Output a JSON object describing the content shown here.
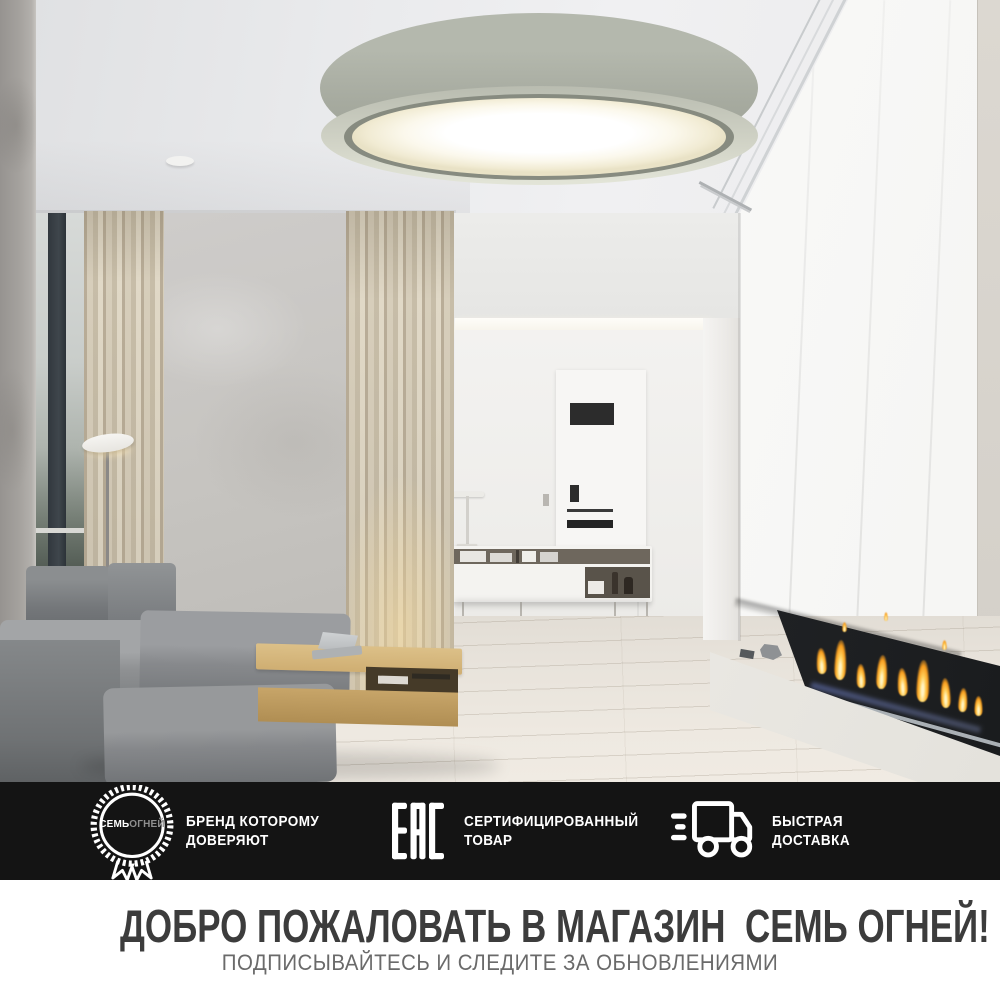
{
  "hero": {
    "scene": "interior-living-room-with-grey-drum-ceiling-lamp"
  },
  "badge_strip": {
    "background": "#141414",
    "items": [
      {
        "icon": "brand-seal-medal-icon",
        "seal_text_bold": "СЕМЬ",
        "seal_text_light": "ОГНЕЙ",
        "line1": "БРЕНД КОТОРОМУ",
        "line2": "ДОВЕРЯЮТ"
      },
      {
        "icon": "eac-certification-mark-icon",
        "line1": "СЕРТИФИЦИРОВАННЫЙ",
        "line2": "ТОВАР"
      },
      {
        "icon": "delivery-truck-icon",
        "line1": "БЫСТРАЯ",
        "line2": "ДОСТАВКА"
      }
    ]
  },
  "footer": {
    "title": "ДОБРО ПОЖАЛОВАТЬ В МАГАЗИН  СЕМЬ ОГНЕЙ!",
    "subtitle": "ПОДПИСЫВАЙТЕСЬ И СЛЕДИТЕ ЗА ОБНОВЛЕНИЯМИ"
  },
  "colors": {
    "strip_background": "#141414",
    "badge_text": "#ffffff",
    "title_text": "#3c3c3c",
    "subtitle_text": "#6a6a6a",
    "flame_accent": "#f79d1e",
    "lamp_shade": "#a6aa9f",
    "wood_table": "#cfae72"
  }
}
